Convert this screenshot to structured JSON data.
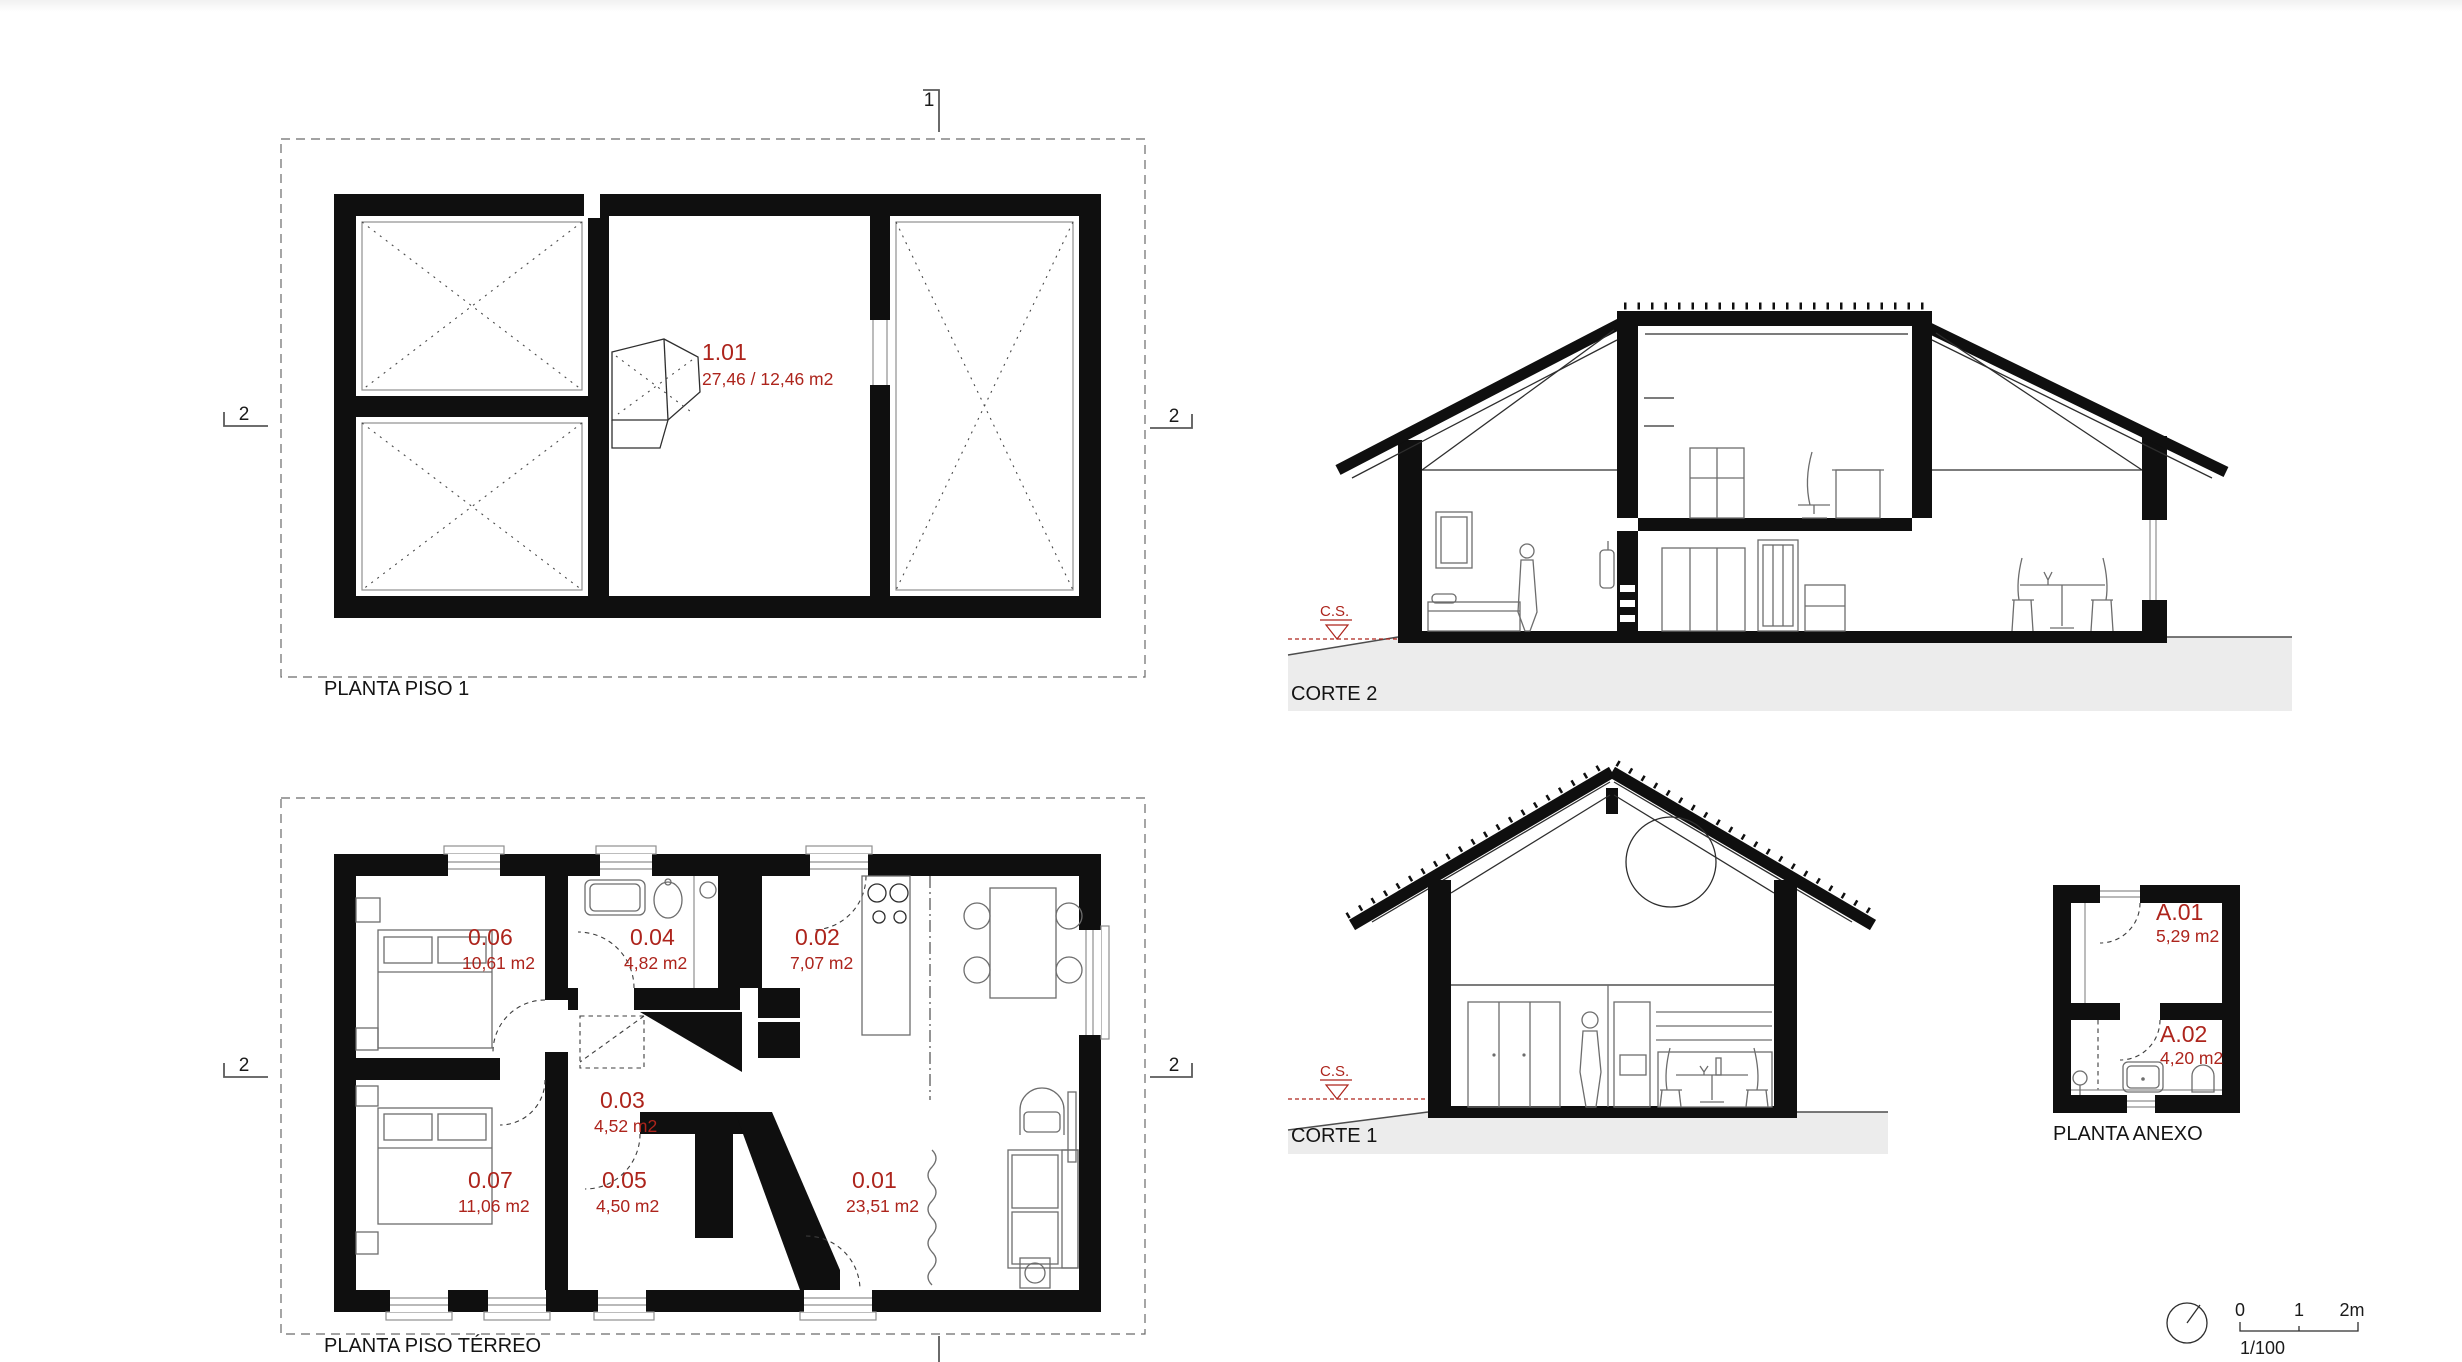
{
  "colors": {
    "label_red": "#ad241c",
    "ink": "#121212",
    "ground_gray": "#ececec",
    "paper_white": "#ffffff"
  },
  "plans": {
    "piso1": {
      "title": "PLANTA PISO 1",
      "rooms": [
        {
          "id": "1.01",
          "area": "27,46 / 12,46 m2"
        }
      ]
    },
    "terreo": {
      "title": "PLANTA PISO TÉRREO",
      "rooms": [
        {
          "id": "0.06",
          "area": "10,61 m2"
        },
        {
          "id": "0.04",
          "area": "4,82 m2"
        },
        {
          "id": "0.02",
          "area": "7,07 m2"
        },
        {
          "id": "0.03",
          "area": "4,52 m2"
        },
        {
          "id": "0.07",
          "area": "11,06 m2"
        },
        {
          "id": "0.05",
          "area": "4,50 m2"
        },
        {
          "id": "0.01",
          "area": "23,51 m2"
        }
      ]
    },
    "anexo": {
      "title": "PLANTA ANEXO",
      "rooms": [
        {
          "id": "A.01",
          "area": "5,29 m2"
        },
        {
          "id": "A.02",
          "area": "4,20 m2"
        }
      ]
    }
  },
  "sections": {
    "corte2": {
      "title": "CORTE 2",
      "level_marker": "C.S."
    },
    "corte1": {
      "title": "CORTE 1",
      "level_marker": "C.S."
    }
  },
  "cut_markers": {
    "cut_1": "1",
    "cut_2": "2"
  },
  "scale_bar": {
    "tick_0": "0",
    "tick_1": "1",
    "tick_2": "2m",
    "scale_ratio": "1/100"
  }
}
